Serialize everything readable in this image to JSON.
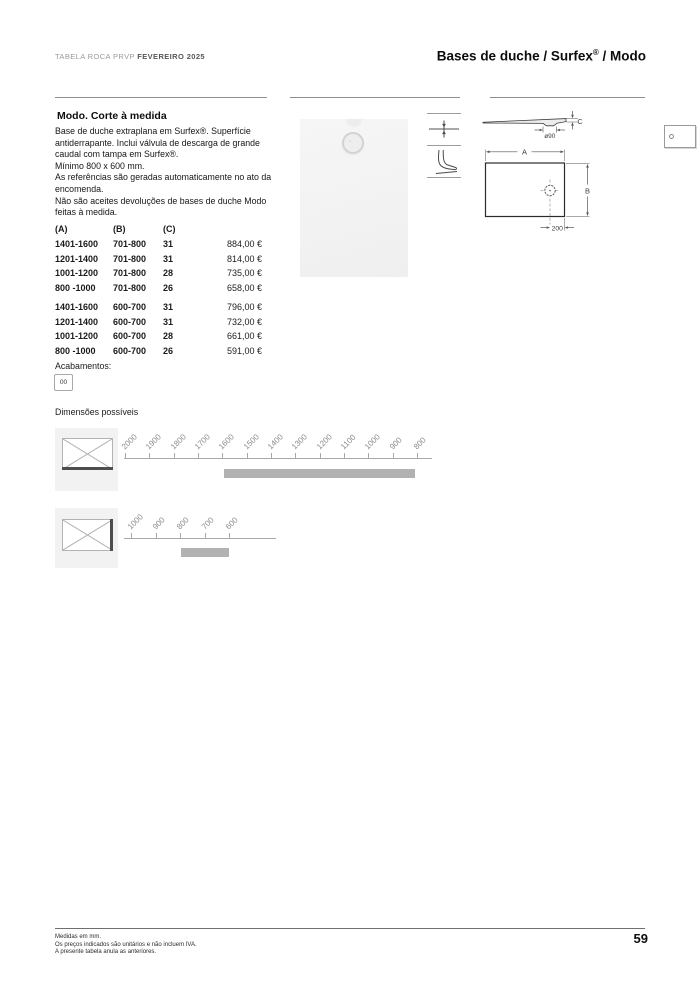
{
  "header": {
    "catalog_label": "TABELA ROCA PRVP",
    "catalog_edition": "FEVEREIRO 2025",
    "title_prefix": "Bases de duche / Surfex",
    "title_reg": "®",
    "title_suffix": " / Modo"
  },
  "product": {
    "section_title": "Modo. Corte à medida",
    "description": [
      "Base de duche extraplana em Surfex®. Superfície antiderrapante. Inclui válvula de descarga de grande caudal com tampa em Surfex®.",
      "Mínimo 800 x 600 mm.",
      "As referências são geradas automaticamente no ato da encomenda.",
      "Não são aceites devoluções de bases de duche Modo feitas à medida."
    ]
  },
  "price_table": {
    "headers": [
      "(A)",
      "(B)",
      "(C)"
    ],
    "groups": [
      {
        "rows": [
          {
            "a": "1401-1600",
            "b": "701-800",
            "c": "31",
            "price": "884,00 €"
          },
          {
            "a": "1201-1400",
            "b": "701-800",
            "c": "31",
            "price": "814,00 €"
          },
          {
            "a": "1001-1200",
            "b": "701-800",
            "c": "28",
            "price": "735,00 €"
          },
          {
            "a": "800 -1000",
            "b": "701-800",
            "c": "26",
            "price": "658,00 €"
          }
        ]
      },
      {
        "rows": [
          {
            "a": "1401-1600",
            "b": "600-700",
            "c": "31",
            "price": "796,00 €"
          },
          {
            "a": "1201-1400",
            "b": "600-700",
            "c": "31",
            "price": "732,00 €"
          },
          {
            "a": "1001-1200",
            "b": "600-700",
            "c": "28",
            "price": "661,00 €"
          },
          {
            "a": "800 -1000",
            "b": "600-700",
            "c": "26",
            "price": "591,00 €"
          }
        ]
      }
    ]
  },
  "finishes": {
    "label": "Acabamentos:",
    "codes": [
      "00"
    ]
  },
  "dimensions": {
    "label": "Dimensões possíveis",
    "width_ruler": {
      "ticks": [
        "2000",
        "1900",
        "1800",
        "1700",
        "1600",
        "1500",
        "1400",
        "1300",
        "1200",
        "1100",
        "1000",
        "900",
        "800"
      ],
      "range_bar": {
        "from": 1600,
        "to": 800
      }
    },
    "depth_ruler": {
      "ticks": [
        "1000",
        "900",
        "800",
        "700",
        "600"
      ],
      "range_bar": {
        "from": 800,
        "to": 600
      }
    }
  },
  "drawing": {
    "width_label": "A",
    "depth_label": "B",
    "height_label": "C",
    "drain_diameter_label": "ø90",
    "drain_offset_label": "200"
  },
  "icons": {
    "flush": "flush-installation-icon",
    "antislip": "antislip-foot-icon"
  },
  "footer": {
    "notes": [
      "Medidas em mm.",
      "Os preços indicados são unitários e não incluem IVA.",
      "A presente tabela anula as anteriores."
    ],
    "page_number": "59"
  },
  "colors": {
    "rule": "#8d8d8d",
    "range_bar": "#b2b2b2",
    "tile_bg": "#f2f2f3",
    "photo_bg": "#f4f4f5"
  }
}
